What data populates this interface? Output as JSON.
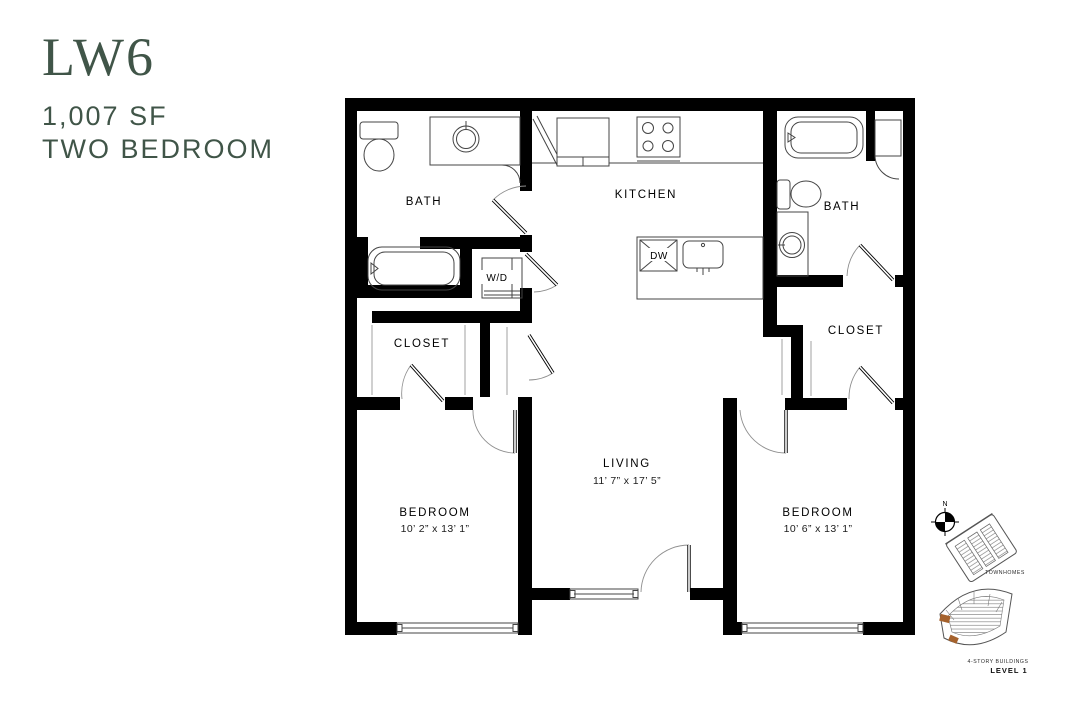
{
  "header": {
    "code": "LW6",
    "area": "1,007 SF",
    "type": "TWO BEDROOM"
  },
  "floorplan": {
    "labels": {
      "bath_left": "BATH",
      "bath_right": "BATH",
      "kitchen": "KITCHEN",
      "washer_dryer": "W/D",
      "dishwasher": "DW",
      "closet_left": "CLOSET",
      "closet_right": "CLOSET",
      "living": {
        "name": "LIVING",
        "dims": "11’ 7” x 17’ 5”"
      },
      "bedroom_left": {
        "name": "BEDROOM",
        "dims": "10’ 2” x 13’ 1”"
      },
      "bedroom_right": {
        "name": "BEDROOM",
        "dims": "10’ 6” x 13’ 1”"
      }
    }
  },
  "sitemap": {
    "north": "N",
    "townhomes_label": "TOWNHOMES",
    "buildings_label": "4-STORY BUILDINGS",
    "level_label": "LEVEL 1"
  },
  "colors": {
    "accent_green": "#405548",
    "highlight_brown": "#a5622d",
    "wall_black": "#000000",
    "background": "#ffffff"
  }
}
